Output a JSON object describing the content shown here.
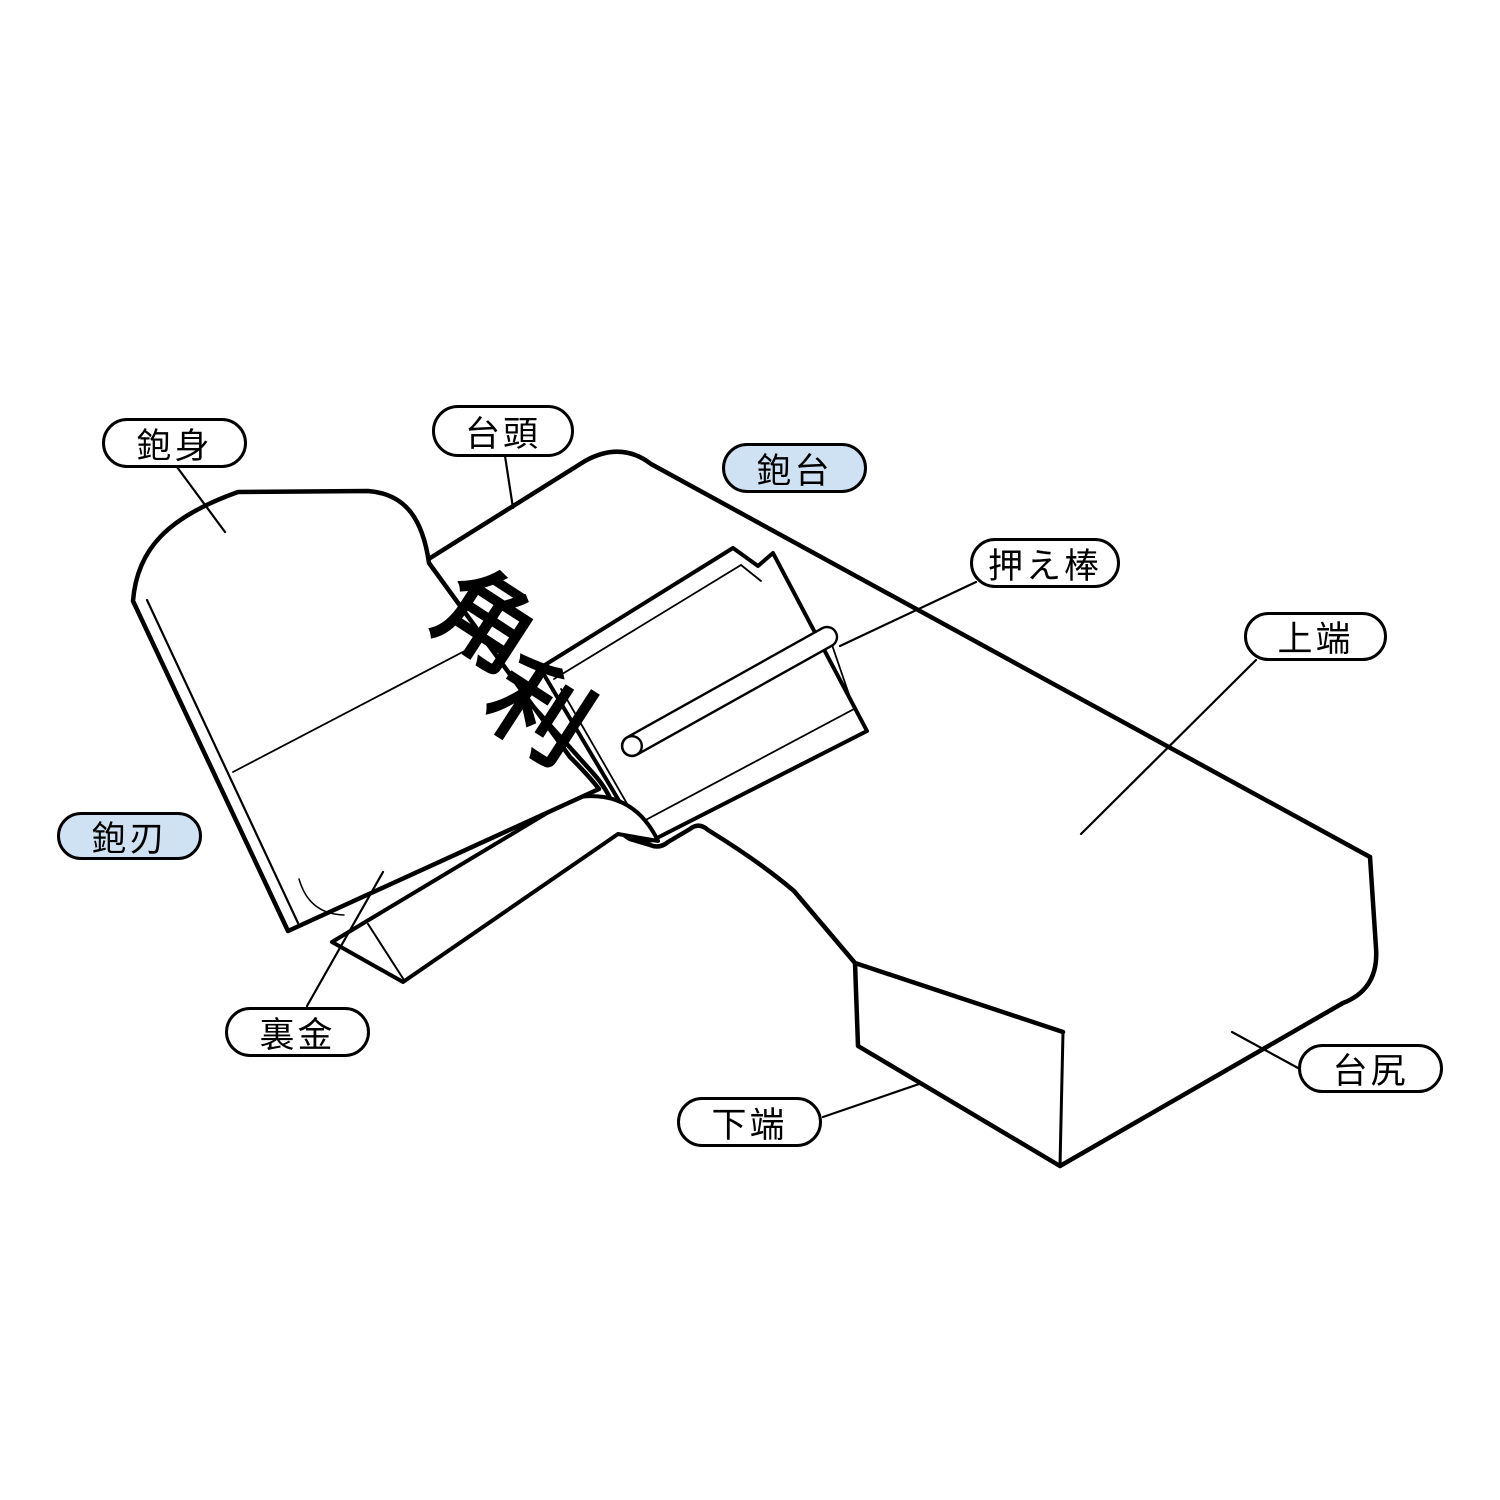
{
  "diagram": {
    "subject": "Japanese hand plane (kanna) parts diagram",
    "blade_marking": {
      "char1": "角",
      "char2": "利"
    },
    "colors": {
      "line": "#000000",
      "highlight_fill": "#cfe2f3",
      "background": "#ffffff"
    },
    "labels": [
      {
        "id": "kanna-mi",
        "text": "鉋身",
        "style": "plain",
        "x": 102,
        "y": 418,
        "w": 145,
        "h": 50
      },
      {
        "id": "dai-gashira",
        "text": "台頭",
        "style": "plain",
        "x": 432,
        "y": 405,
        "w": 142,
        "h": 52
      },
      {
        "id": "kanna-dai",
        "text": "鉋台",
        "style": "highlight",
        "x": 722,
        "y": 443,
        "w": 145,
        "h": 50
      },
      {
        "id": "osae-bo",
        "text": "押え棒",
        "style": "plain",
        "x": 970,
        "y": 538,
        "w": 150,
        "h": 50
      },
      {
        "id": "jo-tan",
        "text": "上端",
        "style": "plain",
        "x": 1244,
        "y": 612,
        "w": 143,
        "h": 49
      },
      {
        "id": "kanna-ba",
        "text": "鉋刃",
        "style": "highlight",
        "x": 57,
        "y": 812,
        "w": 145,
        "h": 48
      },
      {
        "id": "ura-gane",
        "text": "裏金",
        "style": "plain",
        "x": 225,
        "y": 1007,
        "w": 145,
        "h": 50
      },
      {
        "id": "ka-tan",
        "text": "下端",
        "style": "plain",
        "x": 677,
        "y": 1097,
        "w": 145,
        "h": 50
      },
      {
        "id": "dai-jiri",
        "text": "台尻",
        "style": "plain",
        "x": 1298,
        "y": 1044,
        "w": 145,
        "h": 49
      }
    ],
    "leaders": [
      {
        "for": "kanna-mi",
        "x1": 177,
        "y1": 467,
        "x2": 225,
        "y2": 532
      },
      {
        "for": "dai-gashira",
        "x1": 505,
        "y1": 456,
        "x2": 513,
        "y2": 508
      },
      {
        "for": "osae-bo",
        "x1": 976,
        "y1": 582,
        "x2": 840,
        "y2": 646
      },
      {
        "for": "jo-tan",
        "x1": 1256,
        "y1": 660,
        "x2": 1081,
        "y2": 834
      },
      {
        "for": "ura-gane",
        "x1": 307,
        "y1": 1006,
        "x2": 383,
        "y2": 872
      },
      {
        "for": "ka-tan",
        "x1": 823,
        "y1": 1117,
        "x2": 922,
        "y2": 1083
      },
      {
        "for": "dai-jiri",
        "x1": 1298,
        "y1": 1068,
        "x2": 1232,
        "y2": 1032
      }
    ]
  }
}
